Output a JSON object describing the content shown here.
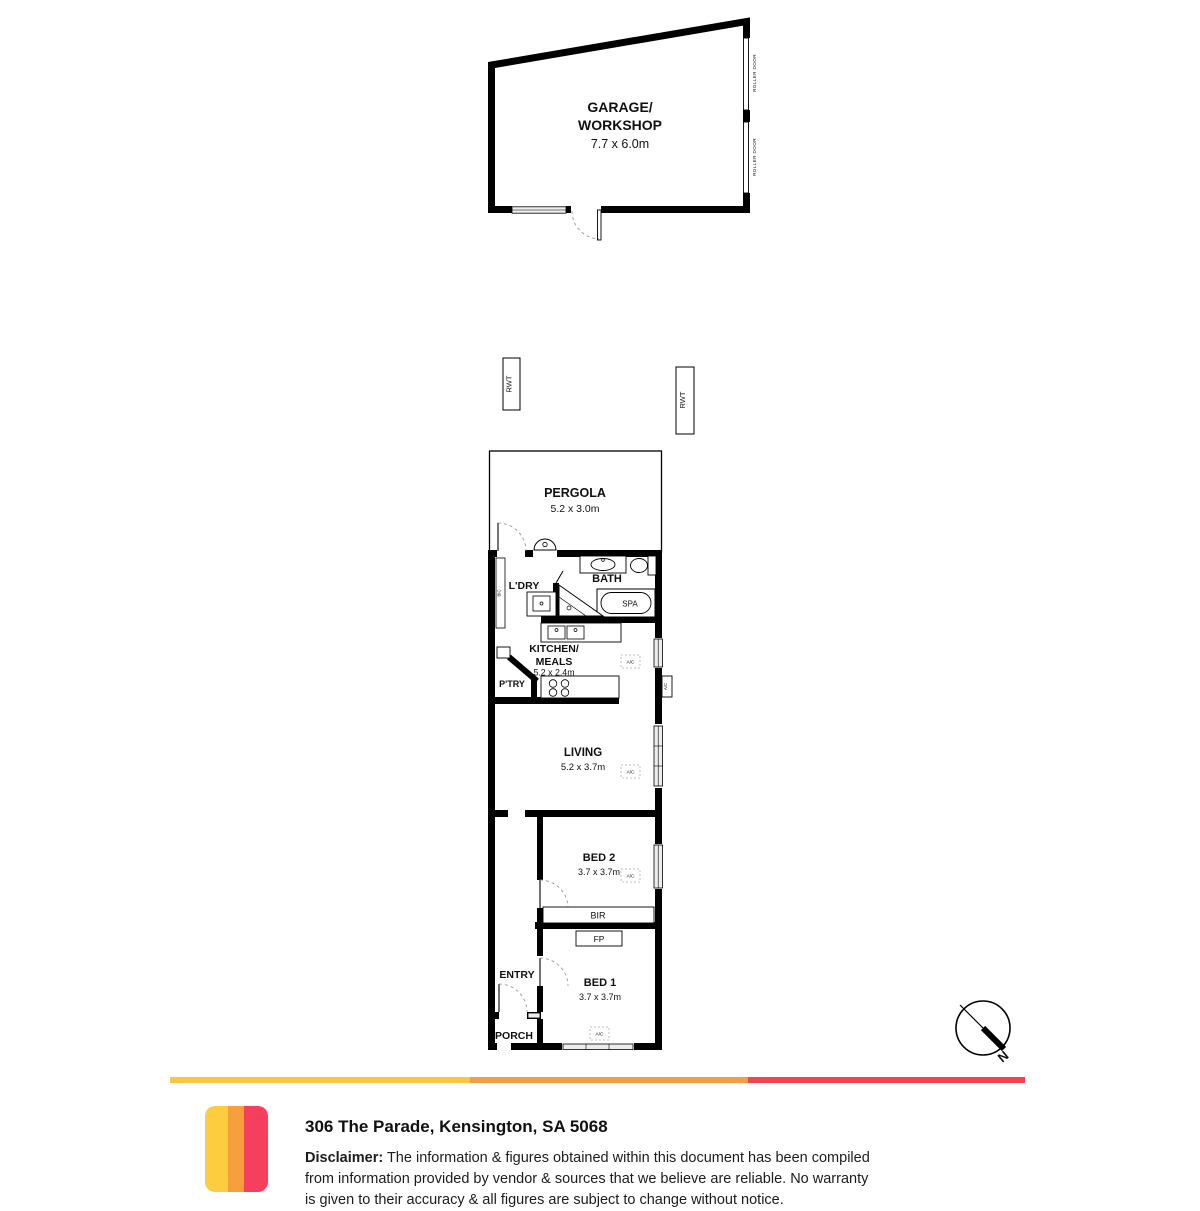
{
  "floorplan": {
    "garage": {
      "name1": "GARAGE/",
      "name2": "WORKSHOP",
      "dims": "7.7 x 6.0m",
      "roller_door": "ROLLER DOOR"
    },
    "rwt": "RWT",
    "pergola": {
      "name": "PERGOLA",
      "dims": "5.2 x 3.0m"
    },
    "laundry": {
      "name": "L'DRY",
      "bic": "BIC"
    },
    "bath": {
      "name": "BATH",
      "spa": "SPA"
    },
    "kitchen": {
      "name1": "KITCHEN/",
      "name2": "MEALS",
      "dims": "5.2 x 2.4m",
      "pantry": "P'TRY"
    },
    "living": {
      "name": "LIVING",
      "dims": "5.2 x 3.7m"
    },
    "bed2": {
      "name": "BED 2",
      "dims": "3.7 x 3.7m"
    },
    "bed1": {
      "name": "BED 1",
      "dims": "3.7 x 3.7m"
    },
    "robe": "BIR",
    "fireplace": "FP",
    "entry": "ENTRY",
    "porch": "PORCH",
    "ac": "A/C",
    "compass_n": "N"
  },
  "footer": {
    "address": "306 The Parade, Kensington, SA 5068",
    "disclaimer": {
      "label": "Disclaimer:",
      "line1": " The information & figures obtained within this document has been compiled",
      "line2": "from information provided by vendor & sources that we believe are reliable. No warranty",
      "line3": "is given to their accuracy & all figures are subject to change without notice."
    },
    "bar_colors": {
      "yellow": "#FBC63F",
      "orange": "#F39C42",
      "red": "#EE454F"
    },
    "logo_colors": {
      "s1": "#FECC3F",
      "s2": "#F79E3D",
      "s3": "#F43F5E"
    }
  }
}
